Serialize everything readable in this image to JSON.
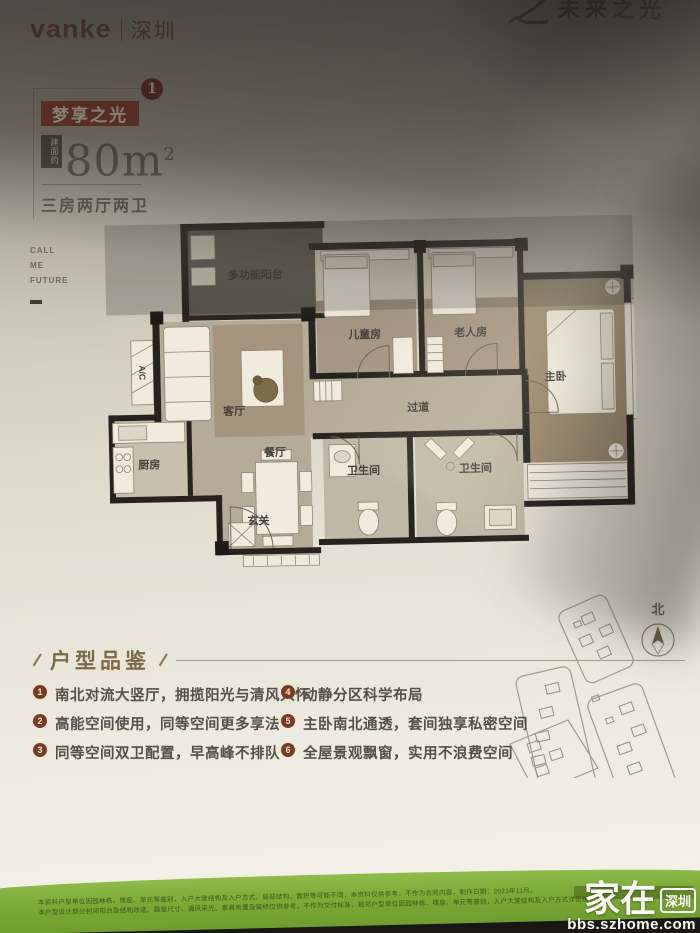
{
  "header": {
    "brand": "vanke",
    "city": "深圳",
    "corner_logo_glyph": "之",
    "corner_logo_text": "未来之光"
  },
  "title_block": {
    "badge_number": "1",
    "name": "梦享之光",
    "area_prefix": "建面约",
    "area_value": "80m",
    "area_sup": "2",
    "layout": "三房两厅两卫",
    "side_note_line1": "CALL",
    "side_note_line2": "ME",
    "side_note_line3": "FUTURE"
  },
  "floor_plan": {
    "rooms": [
      {
        "id": "balcony",
        "label": "多功能阳台"
      },
      {
        "id": "ac-platform",
        "label": "A/C"
      },
      {
        "id": "living-room",
        "label": "客厅"
      },
      {
        "id": "dining-room",
        "label": "餐厅"
      },
      {
        "id": "kitchen",
        "label": "厨房"
      },
      {
        "id": "entry",
        "label": "玄关"
      },
      {
        "id": "kids-room",
        "label": "儿童房"
      },
      {
        "id": "elder-room",
        "label": "老人房"
      },
      {
        "id": "corridor",
        "label": "过道"
      },
      {
        "id": "master-bedroom",
        "label": "主卧"
      },
      {
        "id": "bathroom-1",
        "label": "卫生间"
      },
      {
        "id": "bathroom-2",
        "label": "卫生间"
      }
    ]
  },
  "features": {
    "heading": "户型品鉴",
    "items": [
      {
        "num": "1",
        "text": "南北对流大竖厅，拥揽阳光与清风入怀"
      },
      {
        "num": "2",
        "text": "高能空间使用，同等空间更多享法"
      },
      {
        "num": "3",
        "text": "同等空间双卫配置，早高峰不排队"
      },
      {
        "num": "4",
        "text": "动静分区科学布局"
      },
      {
        "num": "5",
        "text": "主卧南北通透，套间独享私密空间"
      },
      {
        "num": "6",
        "text": "全屋景观飘窗，实用不浪费空间"
      }
    ]
  },
  "site_map": {
    "north_label": "北"
  },
  "footer": {
    "disclaimer_line1": "本资料户型单位因园林栋、楼座、单元等差别，入户大堂结构及入户方式、局部结构、面积等可能不同，本资料仅供参考，不作为合同内容，制作日期：2023年11月。",
    "disclaimer_line2": "本户型设计部分封闭阳台及结构改造、飘窗尺寸、通风采光、家具布置及装修仅供参考，不作为交付标准，相邻户型单位因园林栋、楼座、单元等差别，入户大堂结构及入户方式详见销售现场。",
    "watermark_main": "家在",
    "watermark_badge": "深圳",
    "watermark_url": "bbs.szhome.com"
  },
  "colors": {
    "brand_maroon": "#90392c",
    "paper_light": "#f2efe6",
    "shadow_dark": "#1c1a18",
    "green_bar": "#7cab37",
    "feature_num_bg": "#7c3a22",
    "plan_wall": "#26231e",
    "plan_floor": "#b4ab99",
    "plan_wood": "#a69684"
  }
}
